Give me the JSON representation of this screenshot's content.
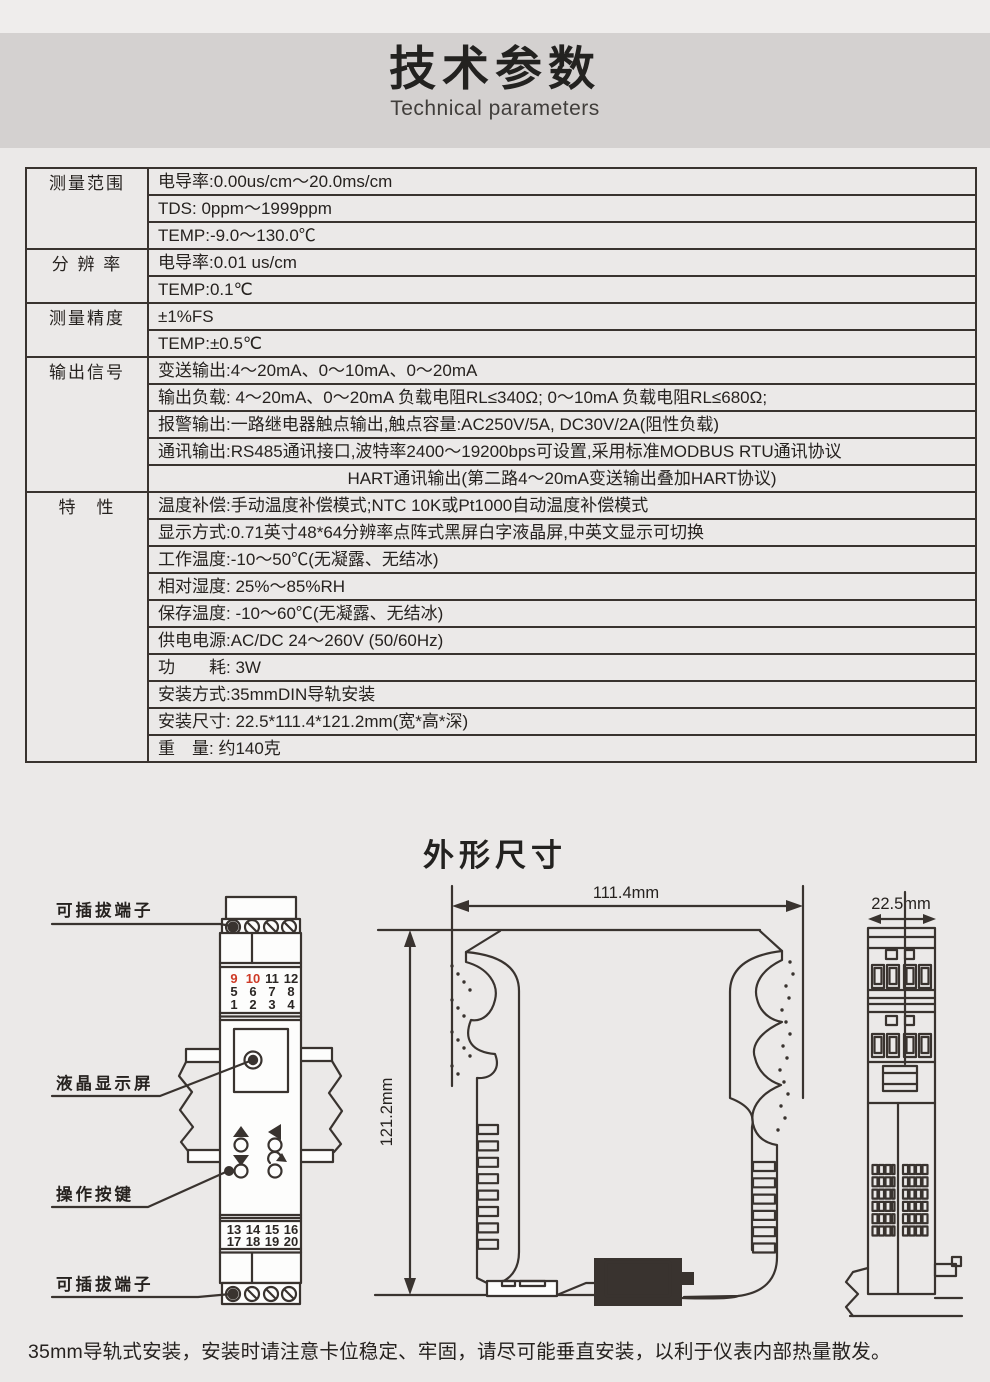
{
  "header": {
    "title": "技术参数",
    "subtitle": "Technical parameters"
  },
  "spec_table": {
    "rows": [
      {
        "label": "测量范围",
        "text": "电导率:0.00us/cm～20.0ms/cm"
      },
      {
        "text": "TDS: 0ppm～1999ppm"
      },
      {
        "text": "TEMP:-9.0～130.0℃"
      },
      {
        "label": "分 辨 率",
        "text": "电导率:0.01 us/cm"
      },
      {
        "text": "TEMP:0.1℃"
      },
      {
        "label": "测量精度",
        "text": "±1%FS"
      },
      {
        "text": "TEMP:±0.5℃"
      },
      {
        "label": "输出信号",
        "text": "变送输出:4～20mA、0～10mA、0～20mA"
      },
      {
        "text": "输出负载: 4～20mA、0～20mA 负载电阻RL≤340Ω; 0～10mA 负载电阻RL≤680Ω;"
      },
      {
        "text": "报警输出:一路继电器触点输出,触点容量:AC250V/5A, DC30V/2A(阻性负载)"
      },
      {
        "text": "通讯输出:RS485通讯接口,波特率2400～19200bps可设置,采用标准MODBUS RTU通讯协议"
      },
      {
        "text": "HART通讯输出(第二路4～20mA变送输出叠加HART协议)"
      },
      {
        "label": "特　性",
        "text": "温度补偿:手动温度补偿模式;NTC 10K或Pt1000自动温度补偿模式"
      },
      {
        "text": "显示方式:0.71英寸48*64分辨率点阵式黑屏白字液晶屏,中英文显示可切换"
      },
      {
        "text": "工作温度:-10～50℃(无凝露、无结冰)"
      },
      {
        "text": "相对湿度: 25%～85%RH"
      },
      {
        "text": "保存温度: -10～60℃(无凝露、无结冰)"
      },
      {
        "text": "供电电源:AC/DC 24～260V (50/60Hz)"
      },
      {
        "text": "功　　耗: 3W"
      },
      {
        "text": "安装方式:35mmDIN导轨安装"
      },
      {
        "text": "安装尺寸: 22.5*111.4*121.2mm(宽*高*深)"
      },
      {
        "text": "重　量: 约140克"
      }
    ]
  },
  "outline": {
    "title": "外形尺寸"
  },
  "drawings": {
    "front_view": {
      "label_terminal_top": "可插拔端子",
      "label_lcd": "液晶显示屏",
      "label_buttons": "操作按键",
      "label_terminal_bottom": "可插拔端子",
      "top_numbers": [
        [
          "9",
          "10",
          "11",
          "12"
        ],
        [
          "5",
          "6",
          "7",
          "8"
        ],
        [
          "1",
          "2",
          "3",
          "4"
        ]
      ],
      "bottom_numbers": [
        [
          "13",
          "14",
          "15",
          "16"
        ],
        [
          "17",
          "18",
          "19",
          "20"
        ]
      ],
      "red_color": "#ce3a26"
    },
    "dimensions": {
      "width": "111.4mm",
      "height": "121.2mm",
      "depth": "22.5mm"
    }
  },
  "footer_note": "35mm导轨式安装，安装时请注意卡位稳定、牢固，请尽可能垂直安装，以利于仪表内部热量散发。"
}
